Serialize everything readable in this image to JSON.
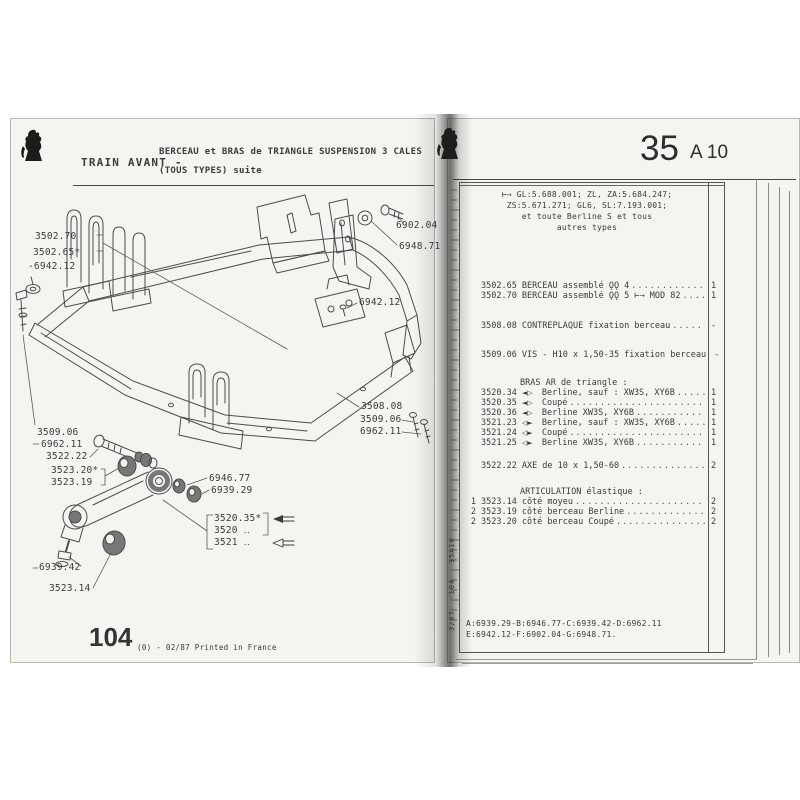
{
  "colors": {
    "ink": "#3b3b3b",
    "page_bg": "#f4f4f1",
    "stroke": "#4c4c4c",
    "rubber": "#777777"
  },
  "icons": {
    "peugeot-lion-logo": "lion-rampant-silhouette",
    "solid-arrow-icon": "◄—",
    "hollow-arrow-icon": "◁—"
  },
  "left_page": {
    "header": {
      "title": "TRAIN AVANT -",
      "subtitle_line1": "BERCEAU et BRAS de TRIANGLE SUSPENSION 3 CALES",
      "subtitle_line2": "(TOUS TYPES) suite"
    },
    "diagram_labels": [
      {
        "id": "l-3502-70",
        "text": "3502.70"
      },
      {
        "id": "l-3502-65",
        "text": "3502.65*"
      },
      {
        "id": "l-6942-12-left",
        "text": "-6942.12"
      },
      {
        "id": "l-6902-04",
        "text": "6902.04"
      },
      {
        "id": "l-6948-71",
        "text": "6948.71"
      },
      {
        "id": "l-6942-12-right",
        "text": "6942.12"
      },
      {
        "id": "l-3508-08",
        "text": "3508.08"
      },
      {
        "id": "l-3509-06-right",
        "text": "3509.06"
      },
      {
        "id": "l-6962-11-right",
        "text": "6962.11"
      },
      {
        "id": "l-3509-06-left",
        "text": "3509.06"
      },
      {
        "id": "l-6962-11-left",
        "text": "6962.11"
      },
      {
        "id": "l-3522-22",
        "text": "3522.22"
      },
      {
        "id": "l-3523-20",
        "text": "3523.20*"
      },
      {
        "id": "l-3523-19",
        "text": "3523.19"
      },
      {
        "id": "l-6946-77",
        "text": "6946.77"
      },
      {
        "id": "l-6939-29",
        "text": "6939.29"
      },
      {
        "id": "l-3520-35",
        "text": "3520.35*"
      },
      {
        "id": "l-3520",
        "text": "3520 ‥"
      },
      {
        "id": "l-3521",
        "text": "3521 ‥"
      },
      {
        "id": "l-6939-42",
        "text": "6939.42"
      },
      {
        "id": "l-3523-14",
        "text": "3523.14"
      }
    ],
    "footer": {
      "page_number": "104",
      "print_note": "(0) - 02/87 Printed in France"
    }
  },
  "right_page": {
    "header": {
      "section_number": "35",
      "section_code": "A 10"
    },
    "applicability_lines": [
      "⊢→ GL:5.688.001; ZL, ZA:5.684.247;",
      "ZS:5.671.271; GL6, SL:7.193.001;",
      "et toute Berline S et tous",
      "autres types"
    ],
    "parts_rows": [
      {
        "type": "item",
        "part": "3502.65",
        "desc": "BERCEAU assemblé ǪǪ 4",
        "qty": "1"
      },
      {
        "type": "item",
        "part": "3502.70",
        "desc": "BERCEAU assemblé ǪǪ 5 ⊢→ MOD 82",
        "qty": "1"
      },
      {
        "type": "item",
        "part": "3508.08",
        "desc": "CONTREPLAQUE fixation berceau",
        "qty": "-"
      },
      {
        "type": "item",
        "part": "3509.06",
        "desc": "VIS - H10 x 1,50-35 fixation berceau",
        "qty": "-"
      },
      {
        "type": "header",
        "text": "BRAS AR de triangle :"
      },
      {
        "type": "item",
        "part": "3520.34",
        "symbol": "◄▷",
        "desc": "Berline, sauf : XW3S, XY6B",
        "qty": "1"
      },
      {
        "type": "item",
        "part": "3520.35",
        "symbol": "◄▷",
        "desc": "Coupé",
        "qty": "1"
      },
      {
        "type": "item",
        "part": "3520.36",
        "symbol": "◄▷",
        "desc": "Berline XW3S, XY6B",
        "qty": "1"
      },
      {
        "type": "item",
        "part": "3521.23",
        "symbol": "◁►",
        "desc": "Berline, sauf : XW3S, XY6B",
        "qty": "1"
      },
      {
        "type": "item",
        "part": "3521.24",
        "symbol": "◁►",
        "desc": "Coupé",
        "qty": "1"
      },
      {
        "type": "item",
        "part": "3521.25",
        "symbol": "◁►",
        "desc": "Berline XW3S, XY6B",
        "qty": "1"
      },
      {
        "type": "item",
        "part": "3522.22",
        "desc": "AXE de 10 x 1,50-60",
        "qty": "2"
      },
      {
        "type": "header",
        "text": "ARTICULATION élastique :"
      },
      {
        "type": "item",
        "ref": "1",
        "part": "3523.14",
        "desc": "côté moyeu",
        "qty": "2"
      },
      {
        "type": "item",
        "ref": "2",
        "part": "3523.19",
        "desc": "côté berceau Berline",
        "qty": "2"
      },
      {
        "type": "item",
        "ref": "2",
        "part": "3523.20",
        "desc": "côté berceau Coupé",
        "qty": "2"
      }
    ],
    "footnote_lines": [
      "A:6939.29-B:6946.77-C:6939.42-D:6962.11",
      "E:6942.12-F:6902.04-G:6948.71."
    ],
    "spine_text": "3/87   104   35A10"
  }
}
